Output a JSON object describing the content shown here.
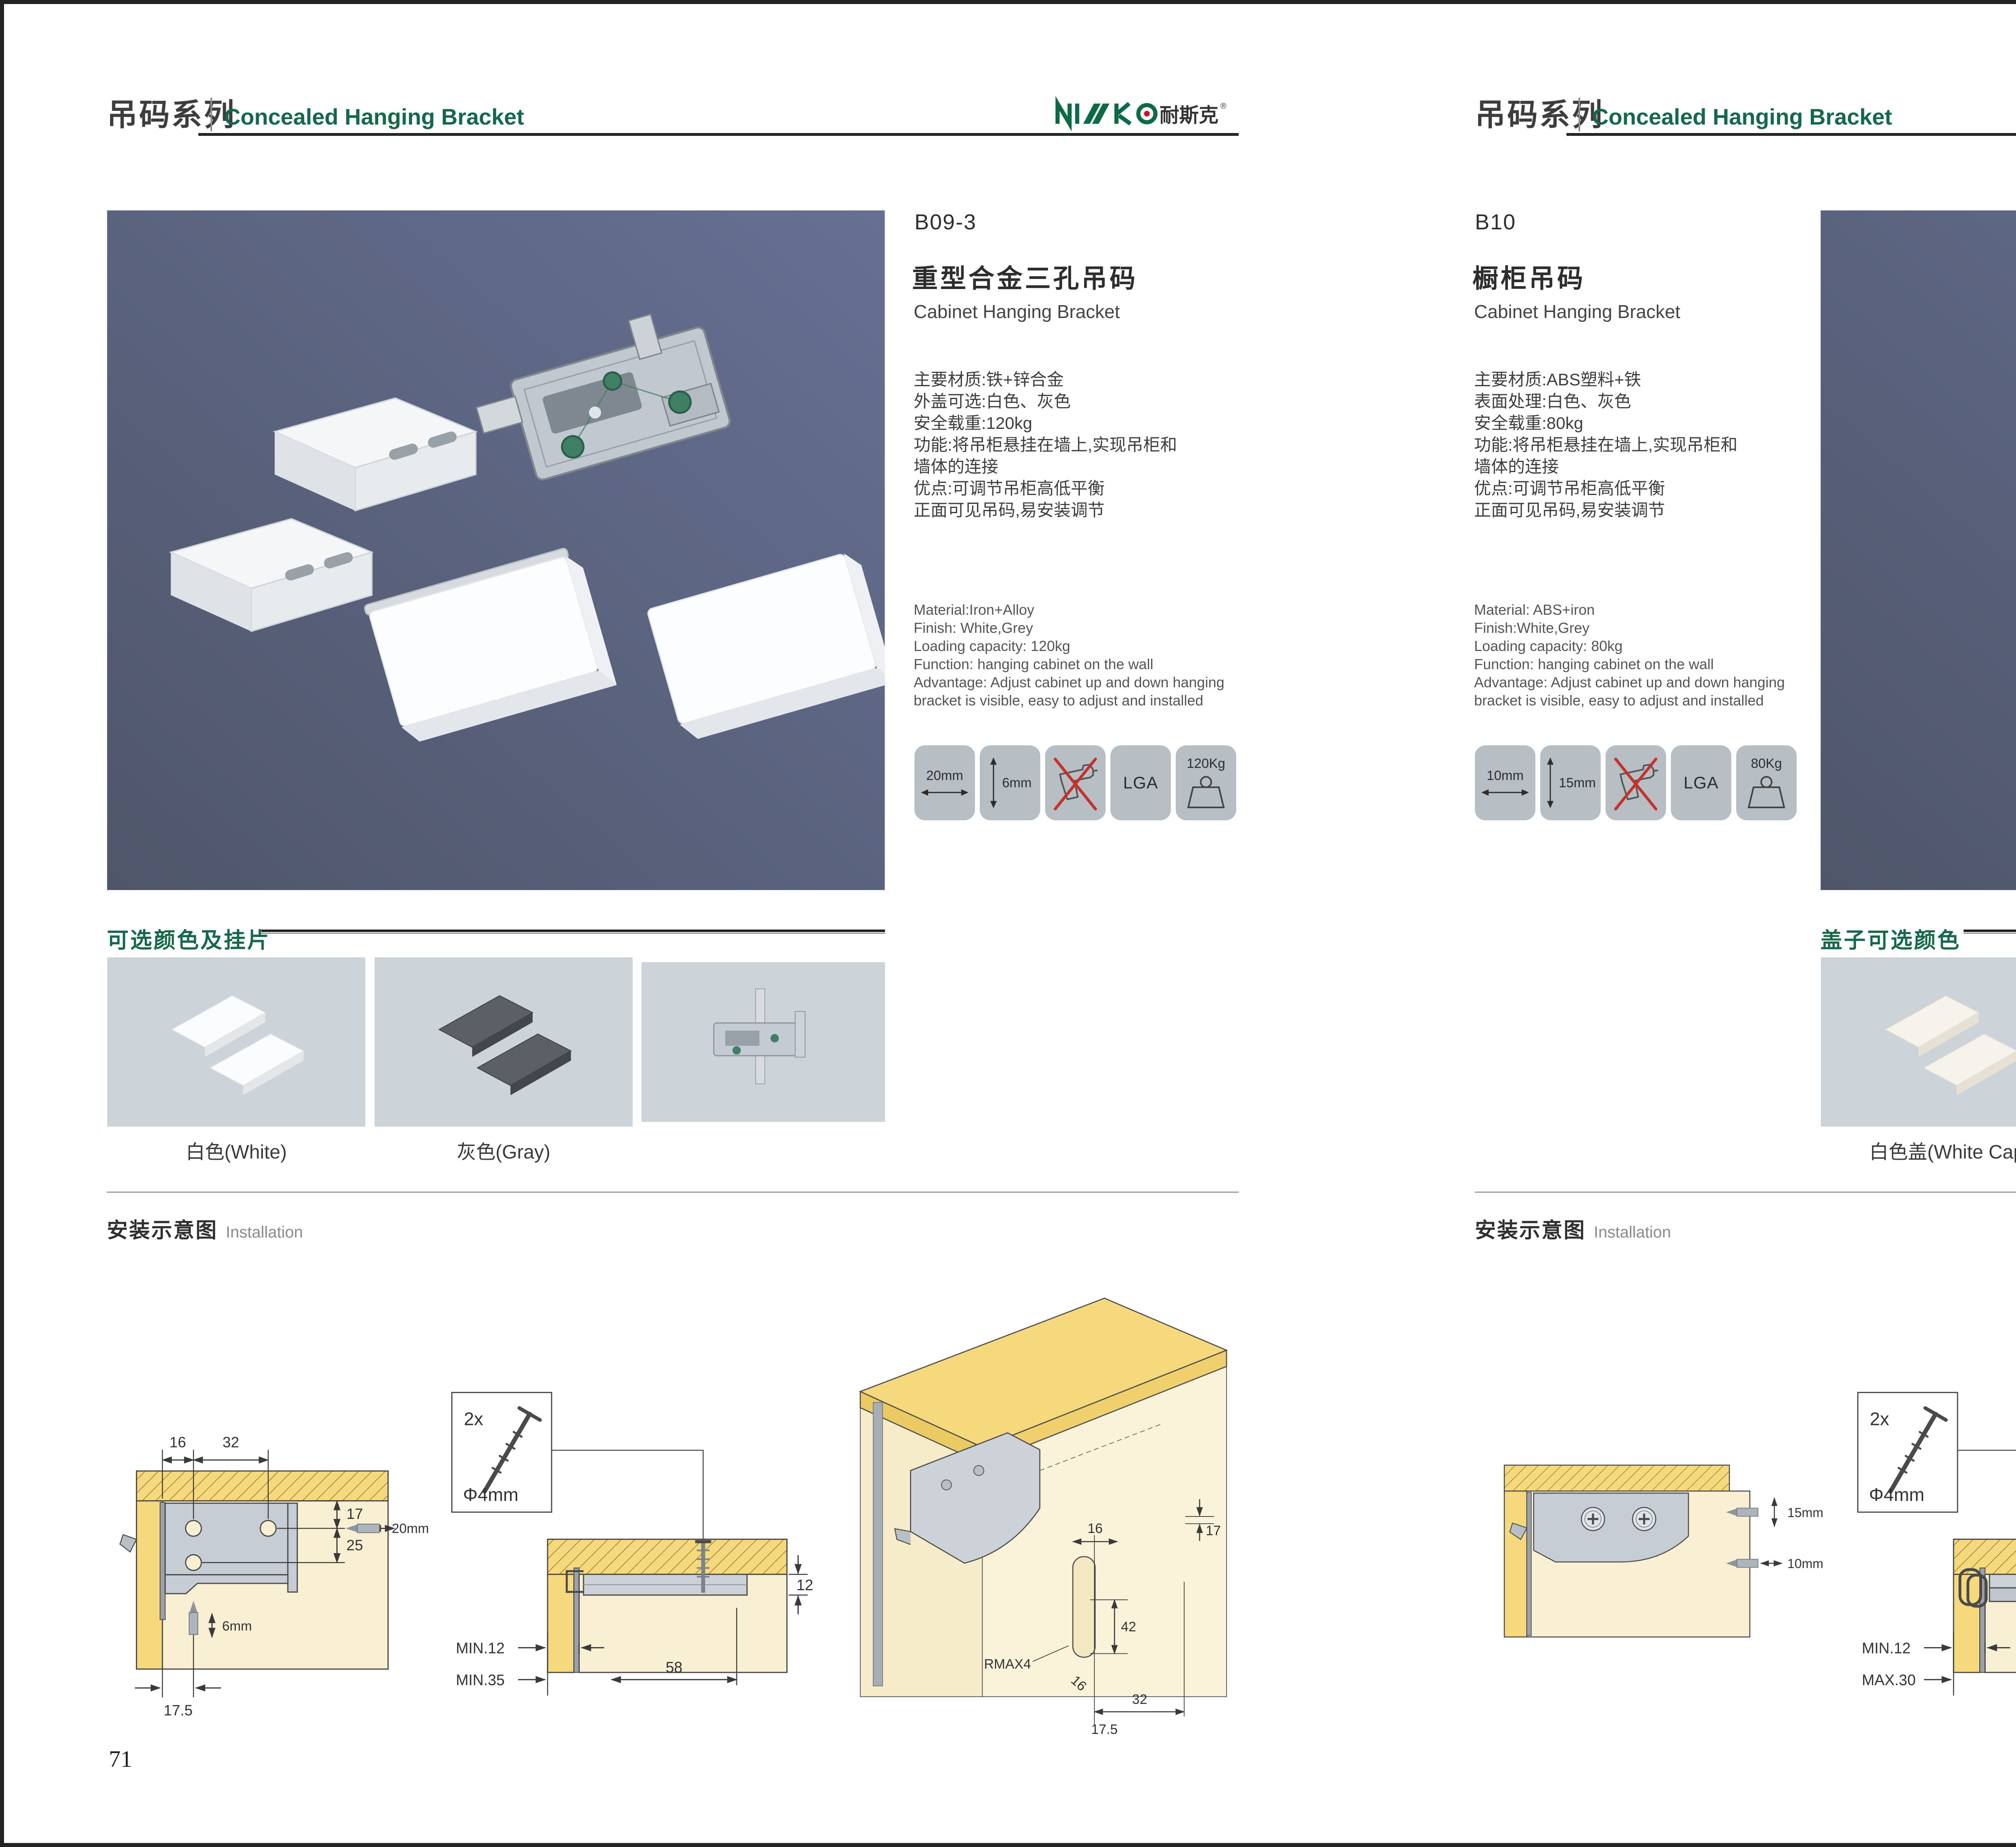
{
  "brand": {
    "logo_latin": "NISKO",
    "logo_zh": "耐斯克",
    "logo_reg": "®"
  },
  "header": {
    "series_zh": "吊码系列",
    "series_en": "Concealed Hanging Bracket"
  },
  "colors": {
    "brand_green": "#0c6b45",
    "logo_red": "#cf1126",
    "photo_bg": "#5b6377",
    "tile_gray": "#b7bec4",
    "wood_yellow": "#f7d97d",
    "panel_cream": "#f9f0d3",
    "swatch_bg": "#ccd3d9"
  },
  "left": {
    "code": "B09-3",
    "name_zh": "重型合金三孔吊码",
    "name_en": "Cabinet Hanging Bracket",
    "specs_zh": [
      "主要材质:铁+锌合金",
      "外盖可选:白色、灰色",
      "安全载重:120kg",
      "功能:将吊柜悬挂在墙上,实现吊柜和",
      "墙体的连接",
      "优点:可调节吊柜高低平衡",
      "正面可见吊码,易安装调节"
    ],
    "specs_en": [
      "Material:Iron+Alloy",
      "Finish: White,Grey",
      "Loading capacity: 120kg",
      "Function: hanging cabinet on the wall",
      "Advantage: Adjust cabinet up and down hanging",
      "bracket is visible, easy to adjust and installed"
    ],
    "icons": {
      "width": "20mm",
      "height": "6mm",
      "cert": "LGA",
      "weight": "120Kg"
    },
    "colors_title": "可选颜色及挂片",
    "swatch_labels": [
      "白色(White)",
      "灰色(Gray)"
    ],
    "install_zh": "安装示意图",
    "install_en": "Installation",
    "d1": {
      "t1": "16",
      "t2": "32",
      "r1": "17",
      "r2": "25",
      "drill_h": "20mm",
      "drill_v": "6mm",
      "b1": "17.5"
    },
    "d2": {
      "qty": "2x",
      "dia": "Φ4mm",
      "side": "12",
      "m1": "MIN.12",
      "m2": "MIN.35",
      "span": "58"
    },
    "d3": {
      "top": "16",
      "right": "17",
      "mid": "42",
      "r": "RMAX4",
      "rot": "16",
      "w": "32",
      "bot": "17.5"
    },
    "page_number": "71"
  },
  "right": {
    "code": "B10",
    "name_zh": "橱柜吊码",
    "name_en": "Cabinet Hanging Bracket",
    "specs_zh": [
      "主要材质:ABS塑料+铁",
      "表面处理:白色、灰色",
      "安全载重:80kg",
      "功能:将吊柜悬挂在墙上,实现吊柜和",
      "墙体的连接",
      "优点:可调节吊柜高低平衡",
      "正面可见吊码,易安装调节"
    ],
    "specs_en": [
      "Material: ABS+iron",
      "Finish:White,Grey",
      "Loading capacity: 80kg",
      "Function: hanging cabinet on the wall",
      "Advantage: Adjust cabinet up and down hanging",
      "bracket is visible, easy to adjust and installed"
    ],
    "icons": {
      "width": "10mm",
      "height": "15mm",
      "cert": "LGA",
      "weight": "80Kg"
    },
    "colors_title": "盖子可选颜色",
    "swatch_labels": [
      "白色盖(White Cap)",
      "灰色盖(Gray Cap)"
    ],
    "install_zh": "安装示意图",
    "install_en": "Installation",
    "d1": {
      "drill_v": "15mm",
      "drill_h": "10mm"
    },
    "d2": {
      "qty": "2x",
      "dia": "Φ4mm",
      "side": "18",
      "m1": "MIN.12",
      "m2": "MAX.30",
      "span": "67"
    },
    "d3": {
      "right": "13",
      "mid": "42",
      "r": "RMAX4",
      "rot": "19",
      "bot": "17",
      "w": "32"
    },
    "page_number": "72"
  }
}
